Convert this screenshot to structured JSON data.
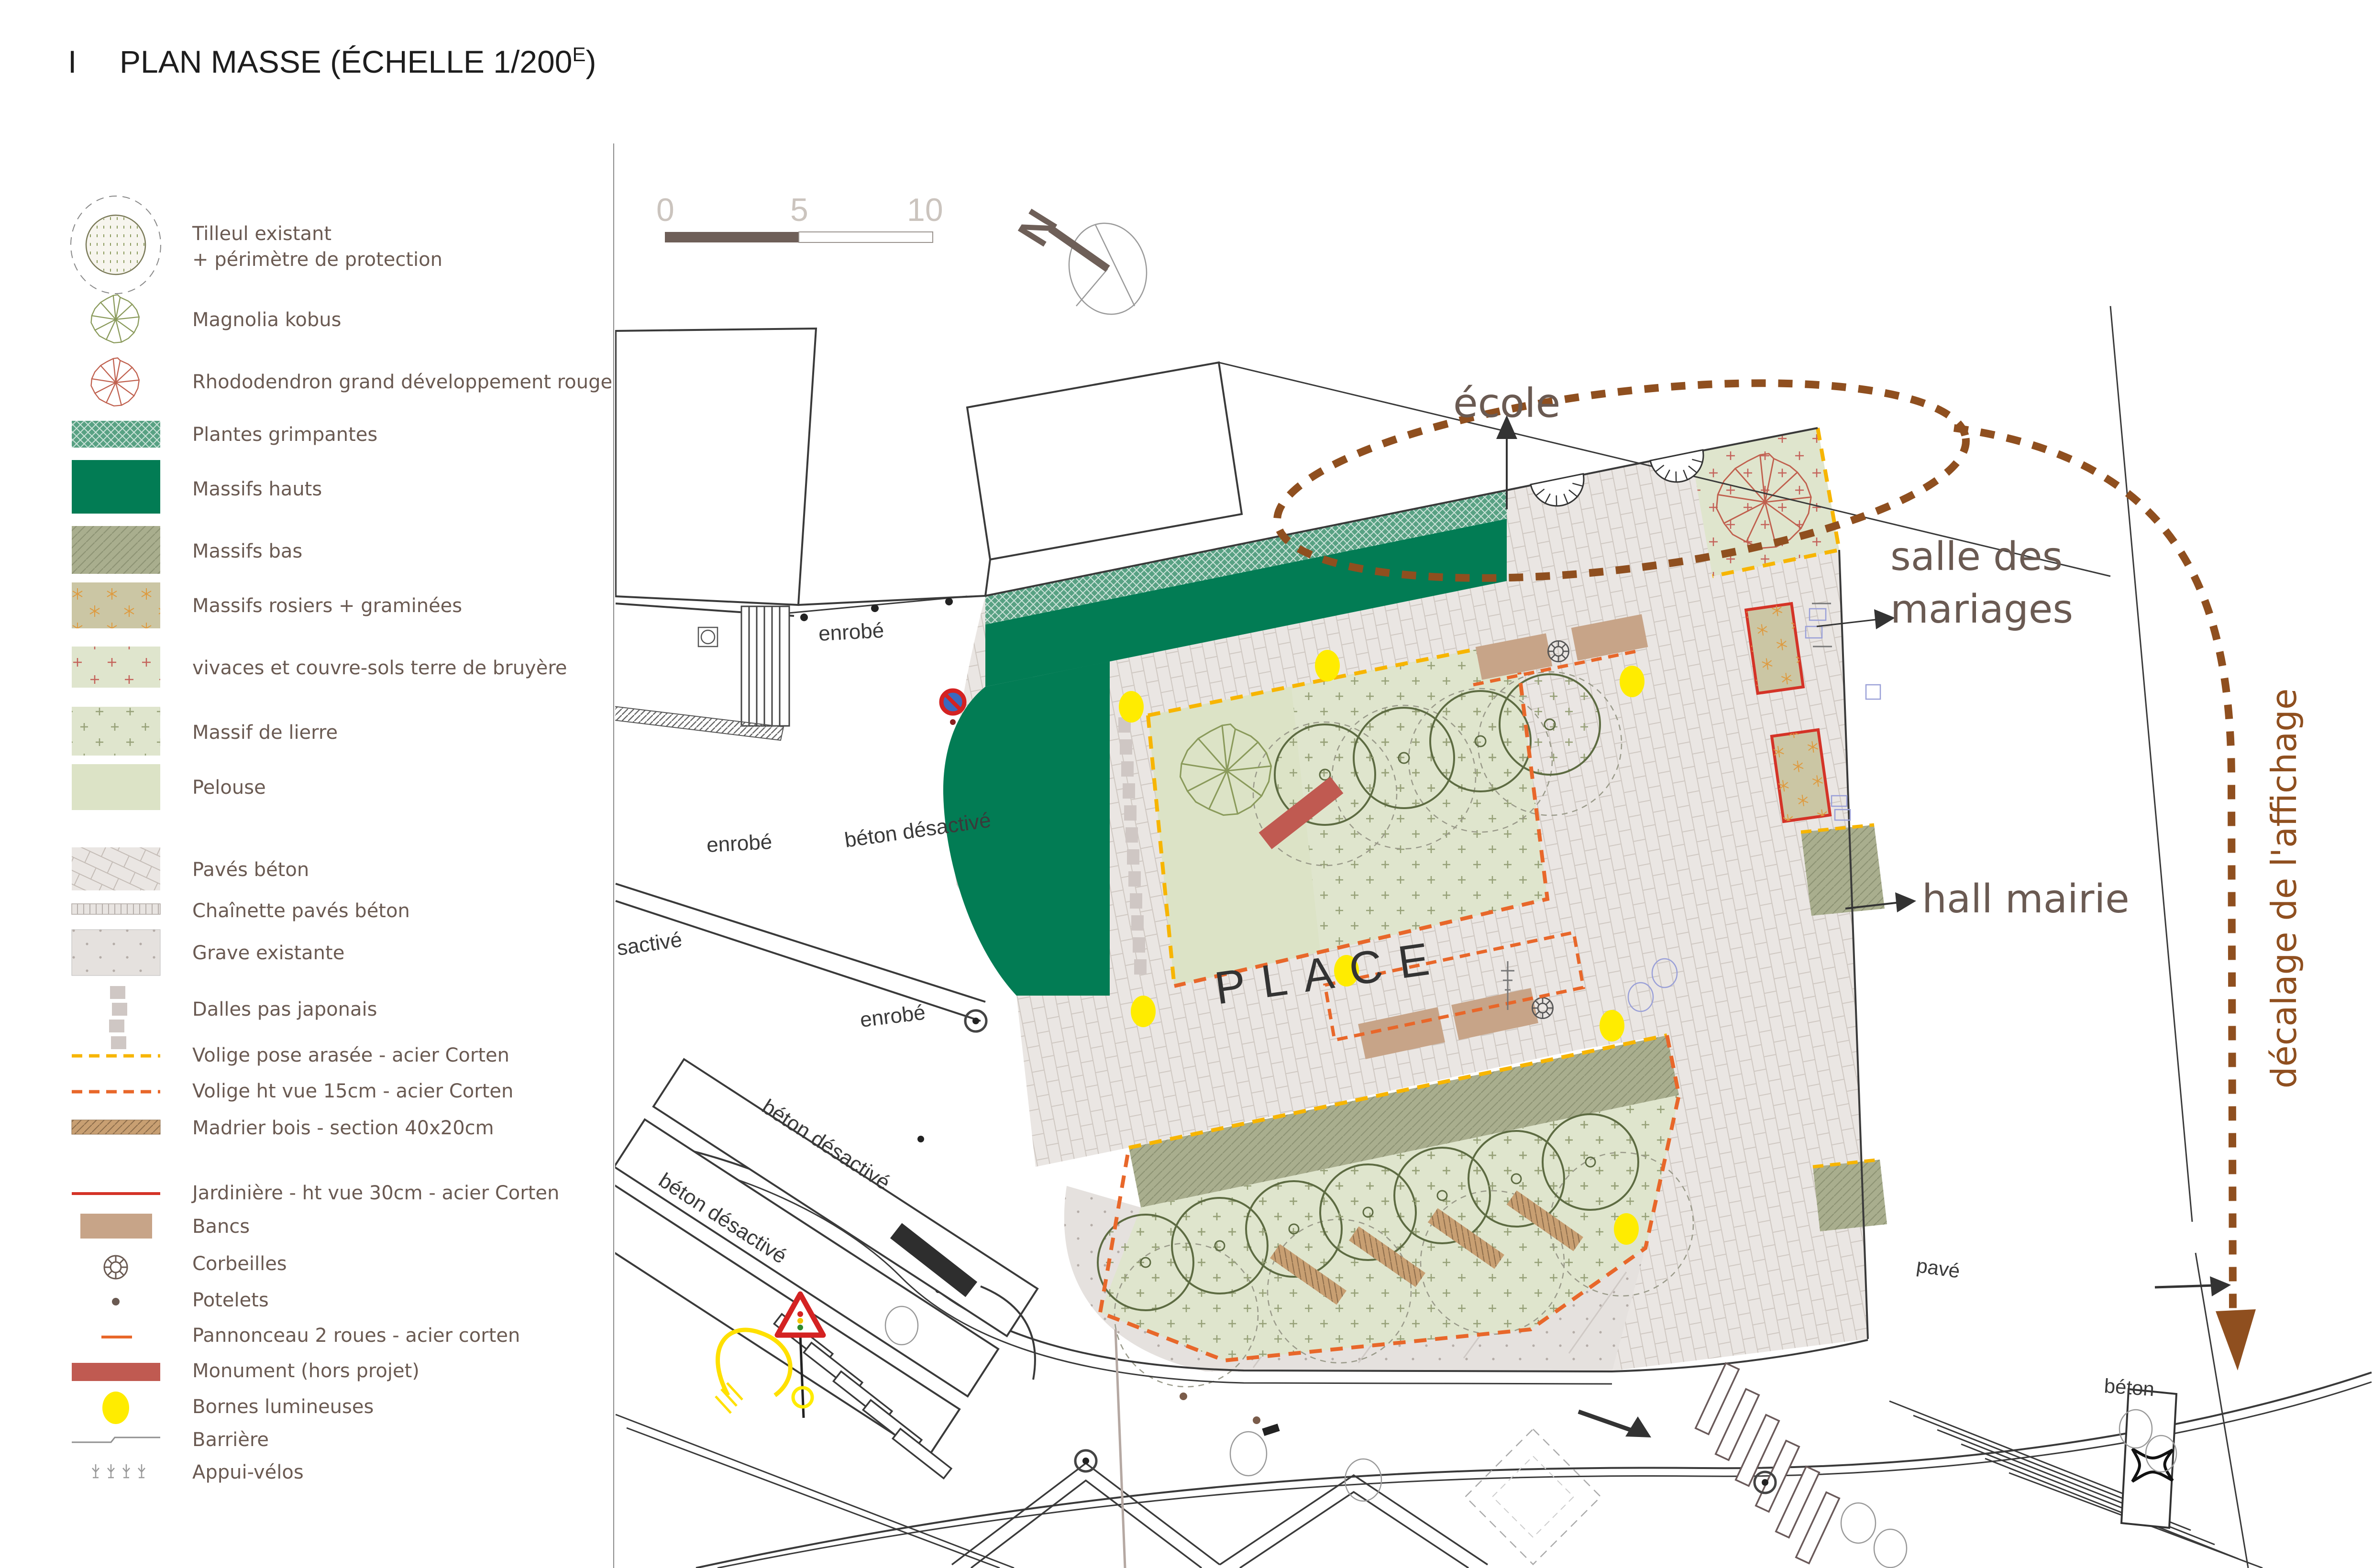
{
  "title": {
    "prefix": "I",
    "main": "PLAN MASSE (ÉCHELLE 1/200",
    "sup": "E",
    "suffix": ")"
  },
  "scale_bar": {
    "ticks": [
      "0",
      "5",
      "10"
    ]
  },
  "north": {
    "label": "N"
  },
  "colors": {
    "legend_text": "#6a5a52",
    "dark_green": "#027c54",
    "seafoam": "#58a183",
    "massif_bas": "#a9ae8e",
    "rosiers": "#cbc6a4",
    "vivaces": "#dfe5cd",
    "pelouse": "#dce3c6",
    "paves": "#eae6e3",
    "grave": "#e5e1de",
    "banc": "#c7a488",
    "monument": "#c05a51",
    "borne": "#ffec00",
    "volige_jaune": "#f7b500",
    "volige_orange": "#e8672a",
    "madrier": "#c89f72",
    "jardiniere": "#d43327",
    "brown_dash": "#8f4f1f"
  },
  "legend": {
    "items": [
      {
        "icon": "tilleul-icon",
        "label": "Tilleul existant",
        "label2": "+ périmètre de protection"
      },
      {
        "icon": "magnolia-icon",
        "label": "Magnolia kobus"
      },
      {
        "icon": "rhododendron-icon",
        "label": "Rhododendron grand développement rouge"
      },
      {
        "icon": "plantes-grimpantes-swatch",
        "label": "Plantes grimpantes"
      },
      {
        "icon": "massifs-hauts-swatch",
        "label": "Massifs hauts"
      },
      {
        "icon": "massifs-bas-swatch",
        "label": "Massifs bas"
      },
      {
        "icon": "massifs-rosiers-swatch",
        "label": "Massifs rosiers + graminées"
      },
      {
        "icon": "vivaces-swatch",
        "label": "vivaces et couvre-sols terre de bruyère"
      },
      {
        "icon": "massif-lierre-swatch",
        "label": "Massif de lierre"
      },
      {
        "icon": "pelouse-swatch",
        "label": "Pelouse"
      },
      {
        "icon": "paves-beton-swatch",
        "label": "Pavés béton"
      },
      {
        "icon": "chainette-swatch",
        "label": "Chaînette pavés béton"
      },
      {
        "icon": "grave-swatch",
        "label": "Grave existante"
      },
      {
        "icon": "dalles-icon",
        "label": "Dalles pas japonais"
      },
      {
        "icon": "volige-jaune-icon",
        "label": "Volige pose arasée - acier Corten"
      },
      {
        "icon": "volige-orange-icon",
        "label": "Volige ht vue 15cm - acier Corten"
      },
      {
        "icon": "madrier-icon",
        "label": "Madrier bois - section 40x20cm"
      },
      {
        "icon": "jardiniere-icon",
        "label": "Jardinière - ht vue 30cm - acier Corten"
      },
      {
        "icon": "banc-icon",
        "label": "Bancs"
      },
      {
        "icon": "corbeille-icon",
        "label": "Corbeilles"
      },
      {
        "icon": "potelet-icon",
        "label": "Potelets"
      },
      {
        "icon": "pannonceau-icon",
        "label": "Pannonceau 2 roues - acier corten"
      },
      {
        "icon": "monument-icon",
        "label": "Monument (hors projet)"
      },
      {
        "icon": "borne-icon",
        "label": "Bornes lumineuses"
      },
      {
        "icon": "barriere-icon",
        "label": "Barrière"
      },
      {
        "icon": "appui-velos-icon",
        "label": "Appui-vélos"
      }
    ]
  },
  "plan": {
    "labels": [
      {
        "text": "école"
      },
      {
        "text": "salle des"
      },
      {
        "text": "mariages"
      },
      {
        "text": "hall mairie"
      },
      {
        "text": "décalage de l'affichage"
      },
      {
        "text": "PLACE"
      },
      {
        "text": "enrobé"
      },
      {
        "text": "enrobé"
      },
      {
        "text": "enrobé"
      },
      {
        "text": "béton désactivé"
      },
      {
        "text": "sactivé"
      },
      {
        "text": "béton désactivé"
      },
      {
        "text": "béton désactivé"
      },
      {
        "text": "pavé"
      },
      {
        "text": "béton"
      }
    ]
  }
}
